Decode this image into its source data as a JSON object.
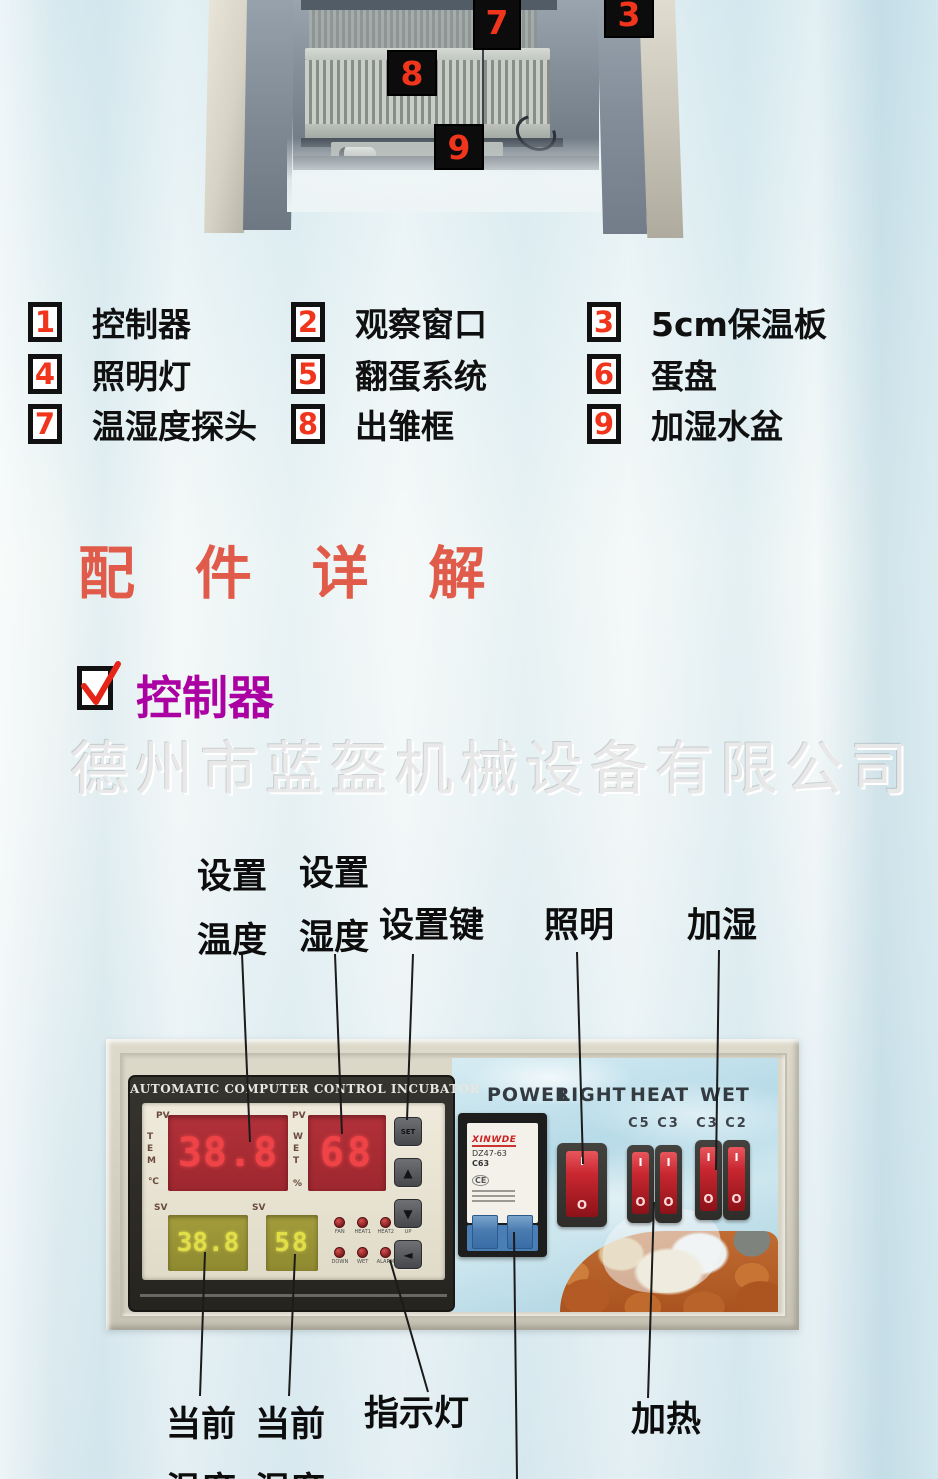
{
  "photo": {
    "badges": {
      "b7": "7",
      "b8": "8",
      "b9": "9",
      "b3": "3"
    }
  },
  "legend": {
    "items": [
      {
        "num": "1",
        "label": "控制器"
      },
      {
        "num": "2",
        "label": "观察窗口"
      },
      {
        "num": "3",
        "label": "5cm保温板"
      },
      {
        "num": "4",
        "label": "照明灯"
      },
      {
        "num": "5",
        "label": "翻蛋系统"
      },
      {
        "num": "6",
        "label": "蛋盘"
      },
      {
        "num": "7",
        "label": "温湿度探头"
      },
      {
        "num": "8",
        "label": "出雏框"
      },
      {
        "num": "9",
        "label": "加湿水盆"
      }
    ]
  },
  "section": {
    "title": "配 件 详 解"
  },
  "subsection": {
    "title": "控制器"
  },
  "watermark": {
    "text": "德州市蓝盔机械设备有限公司"
  },
  "callouts": {
    "set_temp_1": "设置",
    "set_temp_2": "温度",
    "set_hum_1": "设置",
    "set_hum_2": "湿度",
    "set_key": "设置键",
    "lighting": "照明",
    "humidify": "加湿",
    "cur_temp_1": "当前",
    "cur_temp_2": "温度",
    "cur_hum_1": "当前",
    "cur_hum_2": "湿度",
    "indicator": "指示灯",
    "heating": "加热"
  },
  "controller": {
    "header": "AUTOMATIC COMPUTER CONTROL INCUBATOR",
    "pv": "PV",
    "sv": "SV",
    "tem": "TEM",
    "celsius": "℃",
    "wet": "WET",
    "percent": "%",
    "pv_temp": "38.8",
    "pv_wet": "68",
    "sv_temp": "38.8",
    "sv_wet": "58",
    "leds1": [
      "FAN",
      "HEAT1",
      "HEAT2",
      "UP"
    ],
    "leds2": [
      "DOWN",
      "WET",
      "ALARM"
    ],
    "buttons": [
      "SET",
      "▲",
      "▼",
      "◄"
    ]
  },
  "switch_panel": {
    "headers": [
      "POWER",
      "LIGHT",
      "HEAT",
      "WET"
    ],
    "heat_sub": "C5 C3",
    "wet_sub": "C3 C2",
    "rocker_on": "I",
    "rocker_off": "O",
    "breaker": {
      "brand": "XINWDE",
      "model": "DZ47-63",
      "rating": "C63",
      "ce": "CE"
    }
  },
  "colors": {
    "badge_red": "#f1351c",
    "title_red": "#e15b4b",
    "subsection_magenta": "#ab00a2",
    "display_red": "#ef4347",
    "display_yellow": "#e2de48",
    "panel_blue": "#b7dbe8",
    "rocker_red": "#c92730"
  }
}
